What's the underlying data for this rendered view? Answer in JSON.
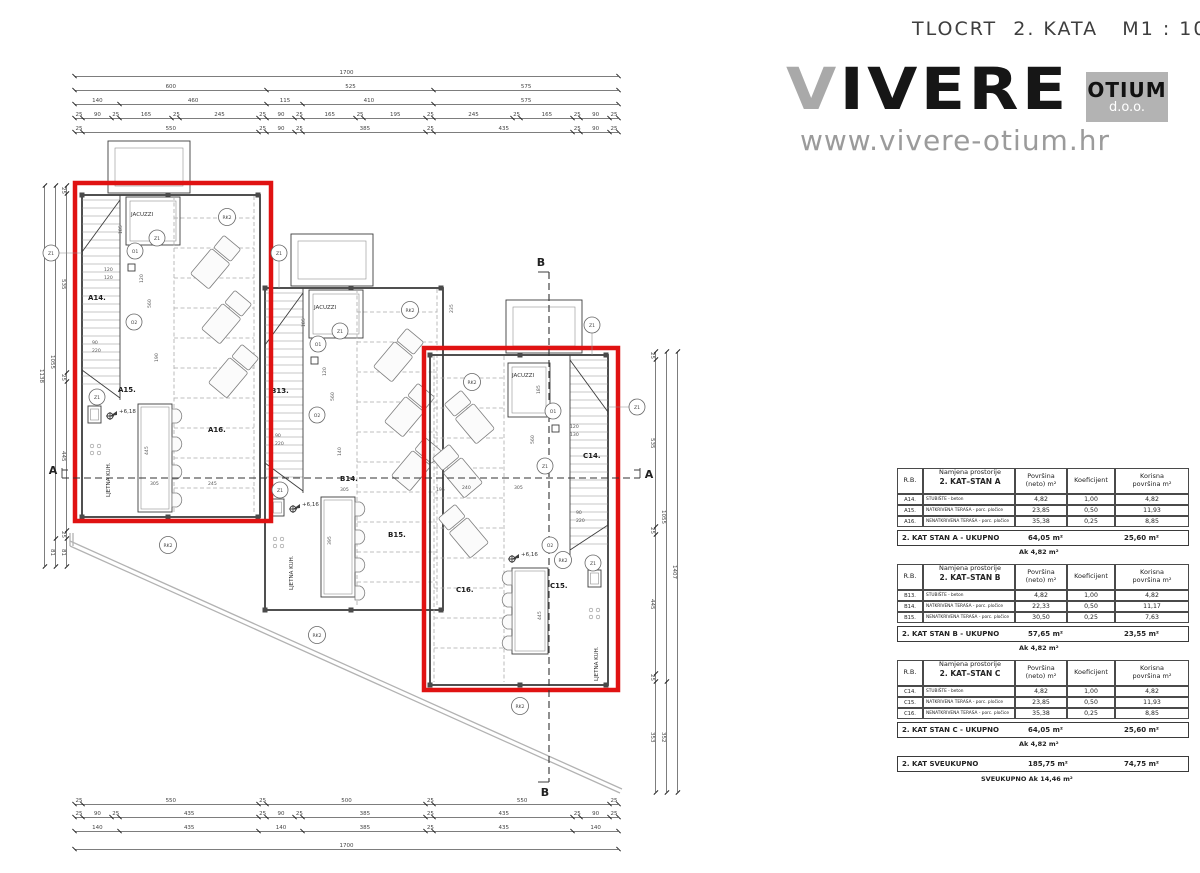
{
  "header": {
    "title": "TLOCRT  2. KATA   M1 : 100"
  },
  "logo": {
    "brand_v": "V",
    "brand_rest": "IVERE",
    "box_top": "OTIUM",
    "box_bottom": "d.o.o.",
    "url": "www.vivere-otium.hr"
  },
  "dims": {
    "top": [
      [
        "1700"
      ],
      [
        "600",
        "525",
        "575"
      ],
      [
        "140",
        "460",
        "115",
        "410",
        "575"
      ],
      [
        "25",
        "90",
        "25",
        "165",
        "25",
        "245",
        "25",
        "90",
        "25",
        "165",
        "25",
        "195",
        "25",
        "245",
        "25",
        "165",
        "25",
        "90",
        "25"
      ],
      [
        "25",
        "550",
        "25",
        "90",
        "25",
        "385",
        "25",
        "435",
        "25",
        "90",
        "25"
      ]
    ],
    "bottom": [
      [
        "25",
        "550",
        "25",
        "500",
        "25",
        "550",
        "25"
      ],
      [
        "25",
        "90",
        "25",
        "435",
        "25",
        "90",
        "25",
        "385",
        "25",
        "435",
        "25",
        "90",
        "25"
      ],
      [
        "140",
        "435",
        "140",
        "385",
        "25",
        "435",
        "140"
      ],
      [
        "1700"
      ]
    ],
    "left": [
      [
        "1138"
      ],
      [
        "1055",
        "81"
      ],
      [
        "25",
        "535",
        "25",
        "445",
        "25",
        "81"
      ]
    ],
    "right": [
      [
        "25",
        "535",
        "25",
        "445",
        "25",
        "353"
      ],
      [
        "1055",
        "352"
      ],
      [
        "1407"
      ]
    ]
  },
  "plan": {
    "sections": {
      "a": "A",
      "b": "B"
    },
    "markers": {
      "z1": "Z1",
      "o1": "O1",
      "o2": "O2",
      "rk2": "RK2"
    },
    "units": {
      "a": {
        "stair_label": "A14.",
        "room1": "A15.",
        "room2": "A16.",
        "jacuzzi": "JACUZZI",
        "kitchen": "LJETNA KUH.",
        "level": "+6,18",
        "dims": {
          "jacuzzi_h": "185",
          "v120": "120",
          "v560": "560",
          "v190": "190",
          "pair1": "120",
          "pair2": "120",
          "kitchen_v": "445",
          "w1": "305",
          "w2": "245",
          "s90": "90",
          "s220": "220"
        }
      },
      "b": {
        "stair_label": "B13.",
        "room1": "B14.",
        "room2": "B15.",
        "jacuzzi": "JACUZZI",
        "kitchen": "LJETNA KUH.",
        "level": "+6,16",
        "dims": {
          "jacuzzi_h": "185",
          "v120": "120",
          "v560": "560",
          "v140": "140",
          "kitchen_v": "395",
          "w1": "305",
          "w2": "195",
          "gap1": "290",
          "gap2": "235",
          "s90": "90",
          "s220": "220"
        }
      },
      "c": {
        "stair_label": "C14.",
        "room1": "C15.",
        "room2": "C16.",
        "jacuzzi": "JACUZZI",
        "kitchen": "LJETNA KUH.",
        "level": "+6,16",
        "dims": {
          "jacuzzi_h": "185",
          "v560": "560",
          "pair1": "120",
          "pair2": "130",
          "kitchen_v": "445",
          "w1": "240",
          "w2": "305",
          "s90": "90",
          "s220": "220"
        }
      }
    }
  },
  "tables": {
    "headers": {
      "rb": "R.B.",
      "name": "Namjena prostorije",
      "area1": "Površina",
      "area2": "(neto) m²",
      "coef": "Koeficijent",
      "use1": "Korisna",
      "use2": "površina m²"
    },
    "groups": [
      {
        "subtitle": "2. KAT–STAN A",
        "rows": [
          {
            "rb": "A14.",
            "name": "STUBIŠTE - beton",
            "area": "4,82",
            "coef": "1,00",
            "useful": "4,82"
          },
          {
            "rb": "A15.",
            "name": "NATKRIVENA TERASA - porc. pločice",
            "area": "23,85",
            "coef": "0,50",
            "useful": "11,93"
          },
          {
            "rb": "A16.",
            "name": "NENATKRIVENA TERASA - porc. pločice",
            "area": "35,38",
            "coef": "0,25",
            "useful": "8,85"
          }
        ],
        "total_label": "2. KAT STAN A - UKUPNO",
        "total_area": "64,05 m²",
        "total_useful": "25,60 m²",
        "ak": "Ak 4,82 m²"
      },
      {
        "subtitle": "2. KAT–STAN B",
        "rows": [
          {
            "rb": "B13.",
            "name": "STUBIŠTE - beton",
            "area": "4,82",
            "coef": "1,00",
            "useful": "4,82"
          },
          {
            "rb": "B14.",
            "name": "NATKRIVENA TERASA - porc. pločice",
            "area": "22,33",
            "coef": "0,50",
            "useful": "11,17"
          },
          {
            "rb": "B15.",
            "name": "NENATKRIVENA TERASA - porc. pločice",
            "area": "30,50",
            "coef": "0,25",
            "useful": "7,63"
          }
        ],
        "total_label": "2. KAT STAN B - UKUPNO",
        "total_area": "57,65 m²",
        "total_useful": "23,55 m²",
        "ak": "Ak 4,82 m²"
      },
      {
        "subtitle": "2. KAT–STAN C",
        "rows": [
          {
            "rb": "C14.",
            "name": "STUBIŠTE - beton",
            "area": "4,82",
            "coef": "1,00",
            "useful": "4,82"
          },
          {
            "rb": "C15.",
            "name": "NATKRIVENA TERASA - porc. pločice",
            "area": "23,85",
            "coef": "0,50",
            "useful": "11,93"
          },
          {
            "rb": "C16.",
            "name": "NENATKRIVENA TERASA - porc. pločice",
            "area": "35,38",
            "coef": "0,25",
            "useful": "8,85"
          }
        ],
        "total_label": "2. KAT STAN C - UKUPNO",
        "total_area": "64,05 m²",
        "total_useful": "25,60 m²",
        "ak": "Ak 4,82 m²"
      }
    ],
    "summary": {
      "label": "2. KAT SVEUKUPNO",
      "area": "185,75 m²",
      "useful": "74,75 m²",
      "ak": "SVEUKUPNO Ak 14,46 m²"
    }
  }
}
